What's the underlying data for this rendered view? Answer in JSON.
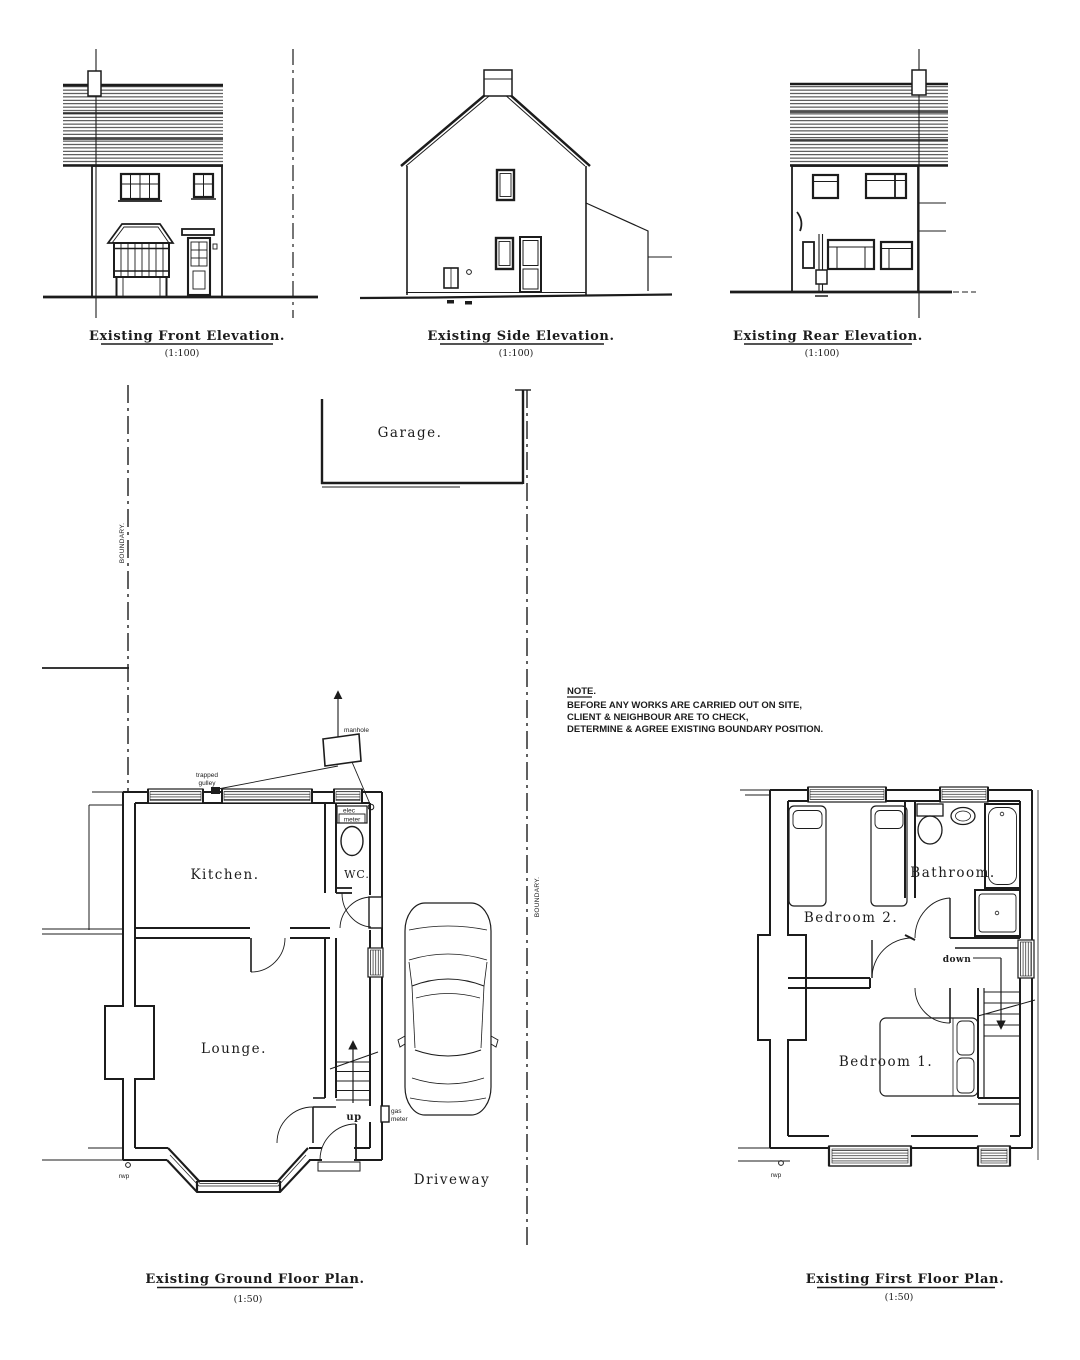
{
  "elevations": {
    "front": {
      "title": "Existing Front Elevation.",
      "scale": "(1:100)"
    },
    "side": {
      "title": "Existing Side Elevation.",
      "scale": "(1:100)"
    },
    "rear": {
      "title": "Existing Rear Elevation.",
      "scale": "(1:100)"
    }
  },
  "site": {
    "garage_label": "Garage.",
    "boundary_label_left": "BOUNDARY.",
    "boundary_label_right": "BOUNDARY.",
    "driveway_label": "Driveway"
  },
  "note": {
    "heading": "NOTE.",
    "lines": [
      "BEFORE ANY WORKS ARE CARRIED OUT ON SITE,",
      "CLIENT & NEIGHBOUR ARE TO CHECK,",
      "DETERMINE & AGREE EXISTING BOUNDARY POSITION."
    ]
  },
  "ground_floor": {
    "title": "Existing Ground Floor Plan.",
    "scale": "(1:50)",
    "rooms": {
      "kitchen": "Kitchen.",
      "wc": "WC.",
      "lounge": "Lounge."
    },
    "annotations": {
      "manhole": "manhole",
      "trapped_gulley_line1": "trapped",
      "trapped_gulley_line2": "gulley",
      "elec_meter_line1": "elec",
      "elec_meter_line2": "meter",
      "gas_meter_line1": "gas",
      "gas_meter_line2": "meter",
      "stairs_up": "up",
      "rwp": "rwp"
    }
  },
  "first_floor": {
    "title": "Existing First Floor Plan.",
    "scale": "(1:50)",
    "rooms": {
      "bedroom2": "Bedroom 2.",
      "bathroom": "Bathroom.",
      "bedroom1": "Bedroom 1."
    },
    "annotations": {
      "stairs_down": "down",
      "rwp": "rwp"
    }
  },
  "colors": {
    "ink": "#1c1c1c",
    "paper": "#ffffff"
  }
}
